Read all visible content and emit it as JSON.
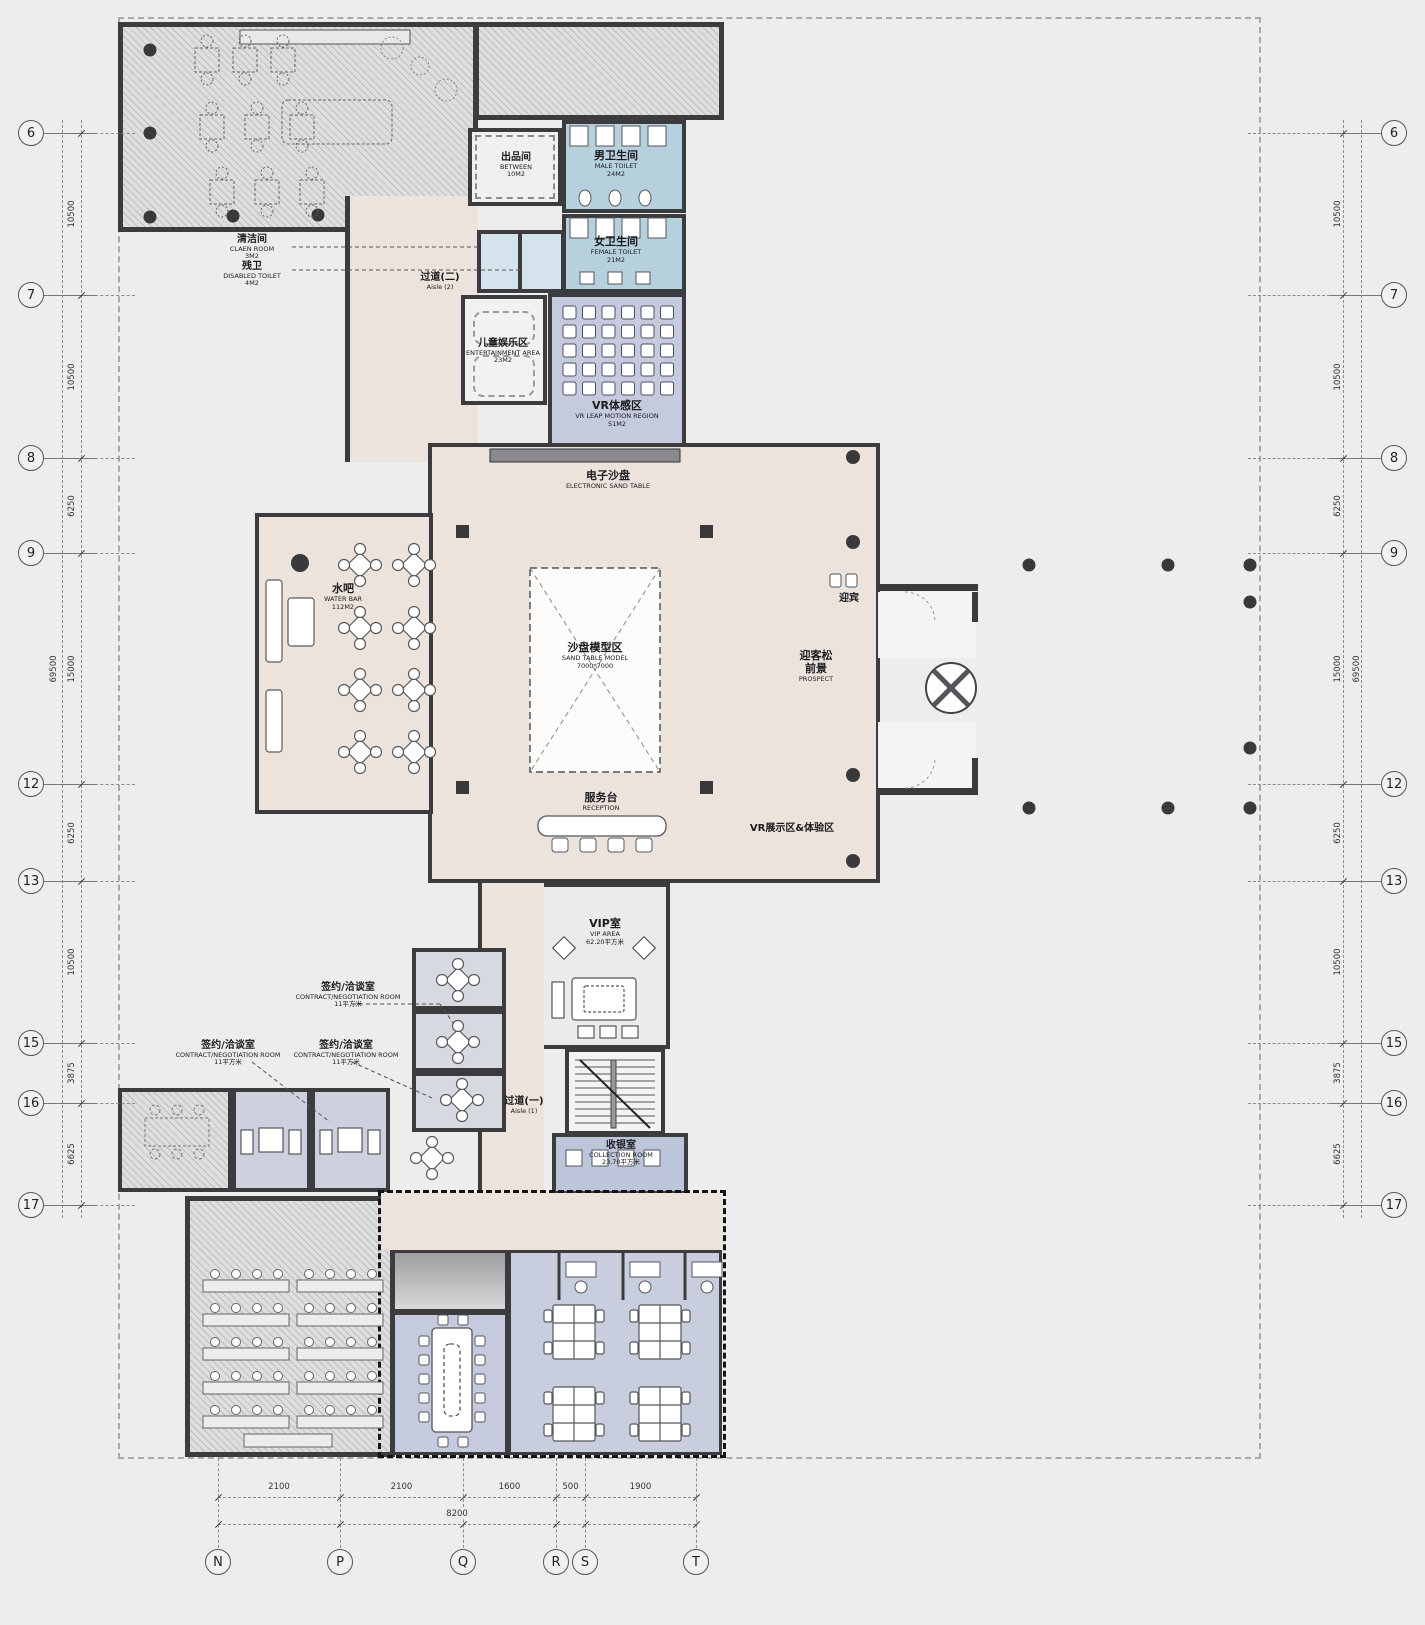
{
  "colors": {
    "wall": "#3c3c3e",
    "hall_pink": "#ece3dd",
    "room_blue": "#c5cade",
    "toilet_blue": "#b6d0de",
    "office_blue": "#c9cede",
    "hatch_gray": "#dedede",
    "column_dark": "#39393b",
    "boundary_dash": "#a9a9a9"
  },
  "rooms": {
    "between": {
      "zh": "出品间",
      "en": "BETWEEN",
      "area": "10M2"
    },
    "male_toilet": {
      "zh": "男卫生间",
      "en": "MALE TOILET",
      "area": "24M2"
    },
    "female_toilet": {
      "zh": "女卫生间",
      "en": "FEMALE TOILET",
      "area": "21M2"
    },
    "clean_room": {
      "zh": "清洁间",
      "en": "CLAEN ROOM",
      "area": "3M2"
    },
    "disabled_toilet": {
      "zh": "残卫",
      "en": "DISABLED TOILET",
      "area": "4M2"
    },
    "aisle2": {
      "zh": "过道(二)",
      "en": "Aisle (2)"
    },
    "kids": {
      "zh": "儿童娱乐区",
      "en": "ENTERTAINMENT AREA",
      "area": "23M2"
    },
    "vr_motion": {
      "zh": "VR体感区",
      "en": "VR LEAP MOTION REGION",
      "area": "51M2"
    },
    "e_sand_table": {
      "zh": "电子沙盘",
      "en": "ELECTRONIC SAND TABLE"
    },
    "water_bar": {
      "zh": "水吧",
      "en": "WATER BAR",
      "area": "112M2"
    },
    "sand_model": {
      "zh": "沙盘模型区",
      "en": "SAND TABLE MODEL",
      "area": "7000*7000"
    },
    "greeting": {
      "zh": "迎宾"
    },
    "prospect": {
      "zh": "迎客松",
      "zh2": "前景",
      "en": "PROSPECT"
    },
    "reception": {
      "zh": "服务台",
      "en": "RECEPTION"
    },
    "vr_show": {
      "zh": "VR展示区&体验区"
    },
    "vip": {
      "zh": "VIP室",
      "en": "VIP AREA",
      "area": "62.20平方米"
    },
    "contract": {
      "zh": "签约/洽谈室",
      "en": "CONTRACT/NEGOTIATION ROOM",
      "area": "11平方米"
    },
    "aisle1": {
      "zh": "过道(一)",
      "en": "Aisle (1)"
    },
    "collection": {
      "zh": "收银室",
      "en": "COLLECTION ROOM",
      "area": "23.70平方米"
    }
  },
  "grid": {
    "rows": [
      {
        "label": "6",
        "y": 133
      },
      {
        "label": "7",
        "y": 295
      },
      {
        "label": "8",
        "y": 458
      },
      {
        "label": "9",
        "y": 553
      },
      {
        "label": "12",
        "y": 784
      },
      {
        "label": "13",
        "y": 881
      },
      {
        "label": "15",
        "y": 1043
      },
      {
        "label": "16",
        "y": 1103
      },
      {
        "label": "17",
        "y": 1205
      }
    ],
    "row_dims": [
      "10500",
      "10500",
      "6250",
      "15000",
      "6250",
      "10500",
      "3875",
      "6625"
    ],
    "row_total": "69500",
    "cols": [
      {
        "label": "N",
        "x": 218
      },
      {
        "label": "P",
        "x": 340
      },
      {
        "label": "Q",
        "x": 463
      },
      {
        "label": "R",
        "x": 556
      },
      {
        "label": "S",
        "x": 585
      },
      {
        "label": "T",
        "x": 696
      }
    ],
    "col_dims": [
      "2100",
      "2100",
      "1600",
      "500",
      "1900"
    ],
    "col_total": "8200"
  }
}
